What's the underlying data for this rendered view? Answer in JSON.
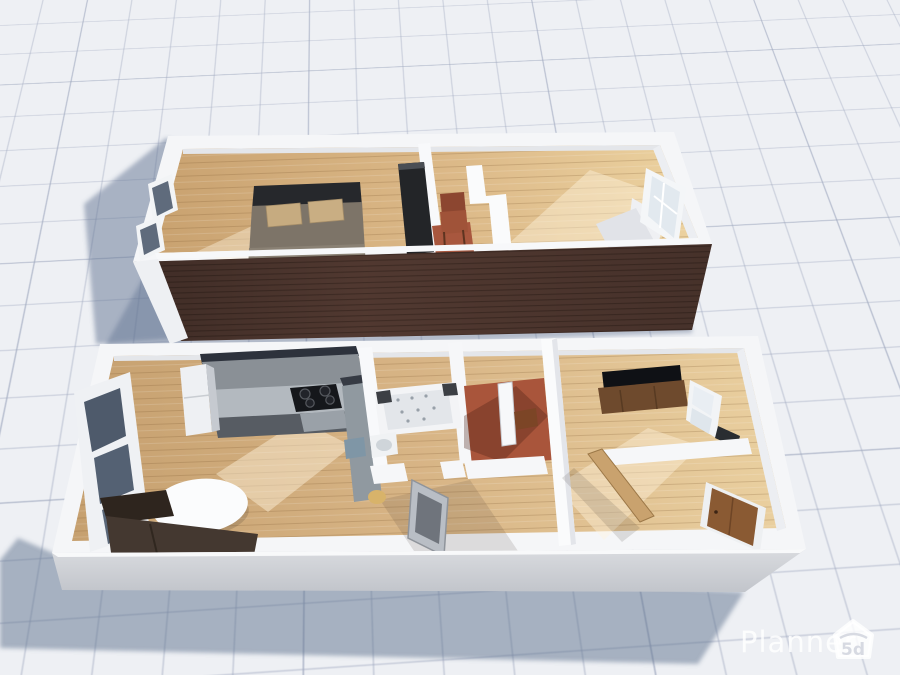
{
  "watermark": {
    "brand": "Planner",
    "badge": "5d",
    "icon": "planner5d-house-icon"
  },
  "palette": {
    "background": "#eef0f4",
    "grid_line": "#c3c9d6",
    "shadow": "#5c6f8e",
    "brick_wall": "#5a3f36",
    "plaster_wall": "#f5f6f8",
    "front_wall_face": "#cdd0d6",
    "wood_floor_light": "#ecd2a0",
    "wood_floor_dark": "#c9a270",
    "terracotta_floor": "#a9553b",
    "watermark_white": "#ffffff"
  },
  "scene": {
    "view_label": "3d-floorplan-render",
    "upper_apartment_rooms": [
      "bedroom",
      "hallway",
      "living-room"
    ],
    "lower_apartment_rooms": [
      "kitchen-living-room",
      "bathroom",
      "entry-hall",
      "tv-room",
      "bedroom"
    ]
  }
}
